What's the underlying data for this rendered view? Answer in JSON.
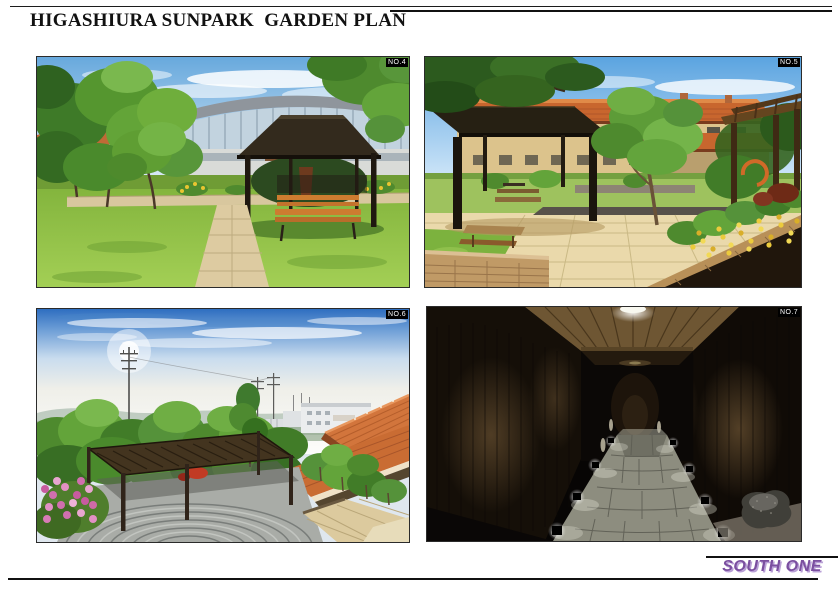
{
  "page": {
    "title": "HIGASHIURA SUNPARK  GARDEN PLAN"
  },
  "figures": [
    {
      "badge": "NO.4",
      "description": "Garden lawn with dark-roof gazebo, orange wooden bench, paved paths and modern curved-roof building behind trees"
    },
    {
      "badge": "NO.5",
      "description": "Paved courtyard with flat shade pavilion, wooden pergola, orange tiled-roof building and yellow flower planter"
    },
    {
      "badge": "NO.6",
      "description": "Elevated view over slatted pergola and circular plaza toward orange tiled roofs, trees, power poles and hazy hills"
    },
    {
      "badge": "NO.7",
      "description": "Night corridor with wood plank ceiling, down-lit walls, stone paving path, ground spotlights and boulder"
    }
  ],
  "footer": {
    "logo_text": "SOUTH ONE",
    "logo_color": "#7b4fa0",
    "logo_shadow_color": "#b9a0d6"
  }
}
